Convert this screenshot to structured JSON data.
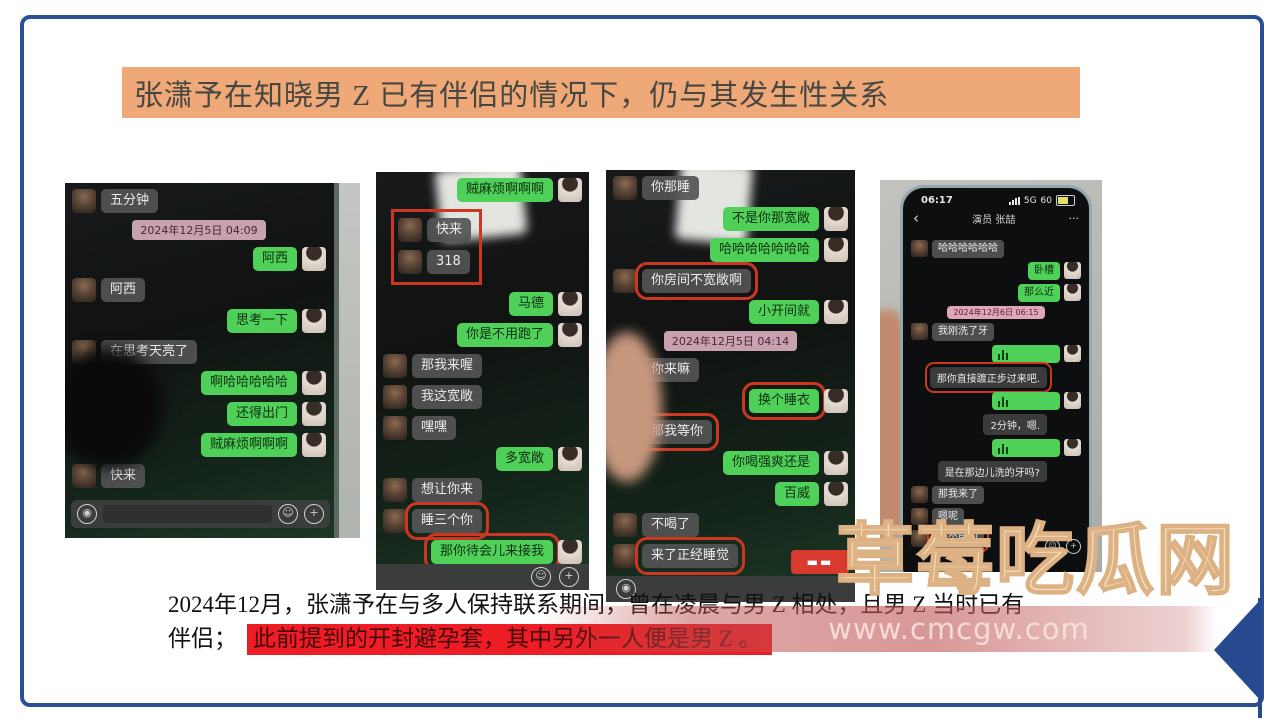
{
  "slide": {
    "title": "张潇予在知晓男 Z 已有伴侣的情况下，仍与其发生性关系",
    "caption_line1": "2024年12月，张潇予在与多人保持联系期间，曾在凌晨与男 Z 相处，且男 Z 当时已有",
    "caption_line2_prefix": "伴侣；",
    "caption_line2_highlight": "此前提到的开封避孕套，其中另外一人便是男 Z 。"
  },
  "watermark": {
    "brand": "草莓吃瓜网",
    "url": "www.cmcgw.com"
  },
  "colors": {
    "frame_blue": "#2a4f96",
    "banner_orange": "#efa878",
    "bubble_green": "#4fd058",
    "highlight_red": "#ee1c24",
    "annotation_red": "#cc3722"
  },
  "input_bar_icons": {
    "speaker": "speaker-icon",
    "emoji": "☺",
    "plus": "+"
  },
  "phones": [
    {
      "id": "phone-1",
      "messages": [
        {
          "side": "left",
          "text": "五分钟"
        },
        {
          "type": "timestamp",
          "text": "2024年12月5日 04:09"
        },
        {
          "side": "right",
          "text": "阿西"
        },
        {
          "side": "left",
          "text": "阿西"
        },
        {
          "side": "right",
          "text": "思考一下"
        },
        {
          "side": "left",
          "text": "在思考天亮了"
        },
        {
          "side": "right",
          "text": "啊哈哈哈哈哈"
        },
        {
          "side": "right",
          "text": "还得出门"
        },
        {
          "side": "right",
          "text": "贼麻烦啊啊啊"
        },
        {
          "side": "left",
          "text": "快来"
        }
      ]
    },
    {
      "id": "phone-2",
      "messages": [
        {
          "side": "right",
          "text": "贼麻烦啊啊啊"
        },
        {
          "type": "box_group",
          "messages": [
            {
              "side": "left",
              "text": "快来"
            },
            {
              "side": "left",
              "text": "318"
            }
          ]
        },
        {
          "side": "right",
          "text": "马德"
        },
        {
          "side": "right",
          "text": "你是不用跑了"
        },
        {
          "side": "left",
          "text": "那我来喔"
        },
        {
          "side": "left",
          "text": "我这宽敞"
        },
        {
          "side": "left",
          "text": "嘿嘿"
        },
        {
          "side": "right",
          "text": "多宽敞"
        },
        {
          "side": "left",
          "text": "想让你来"
        },
        {
          "side": "left",
          "text": "睡三个你",
          "boxed": true
        },
        {
          "side": "right",
          "text": "那你待会儿来接我",
          "boxed": true
        },
        {
          "side": "left",
          "text": "出发吧"
        }
      ]
    },
    {
      "id": "phone-3",
      "messages": [
        {
          "side": "left",
          "text": "你那睡"
        },
        {
          "side": "right",
          "text": "不是你那宽敞"
        },
        {
          "side": "right",
          "text": "哈哈哈哈哈哈哈"
        },
        {
          "side": "left",
          "text": "你房间不宽敞啊",
          "boxed": true
        },
        {
          "side": "right",
          "text": "小开间就"
        },
        {
          "type": "timestamp",
          "text": "2024年12月5日 04:14"
        },
        {
          "side": "left",
          "text": "你来嘛"
        },
        {
          "side": "right",
          "text": "换个睡衣",
          "boxed": true
        },
        {
          "side": "left",
          "text": "那我等你",
          "boxed": true
        },
        {
          "side": "right",
          "text": "你喝强爽还是"
        },
        {
          "side": "right",
          "text": "百威"
        },
        {
          "side": "left",
          "text": "不喝了"
        },
        {
          "side": "left",
          "text": "来了正经睡觉",
          "boxed": true
        }
      ]
    },
    {
      "id": "phone-4",
      "chrome": {
        "time": "06:17",
        "network": "5G",
        "battery": "60",
        "back": "‹",
        "title": "演员 张喆",
        "more": "···"
      },
      "messages": [
        {
          "side": "left",
          "text": "哈哈哈哈哈哈"
        },
        {
          "side": "right",
          "text": "卧槽"
        },
        {
          "side": "right",
          "text": "那么近"
        },
        {
          "type": "timestamp",
          "text": "2024年12月6日 06:15"
        },
        {
          "side": "left",
          "text": "我刚洗了牙"
        },
        {
          "side": "right",
          "type": "voice"
        },
        {
          "type": "transcript",
          "text": "那你直接踱正步过来吧.",
          "boxed": true
        },
        {
          "side": "right",
          "type": "voice"
        },
        {
          "type": "transcript",
          "text": "2分钟，嗯."
        },
        {
          "side": "right",
          "type": "voice"
        },
        {
          "type": "transcript",
          "text": "是在那边儿洗的牙吗?"
        },
        {
          "side": "left",
          "text": "那我来了"
        },
        {
          "side": "left",
          "text": "嗯呢"
        },
        {
          "side": "left",
          "text": "换个房间",
          "boxed": true
        }
      ]
    }
  ]
}
